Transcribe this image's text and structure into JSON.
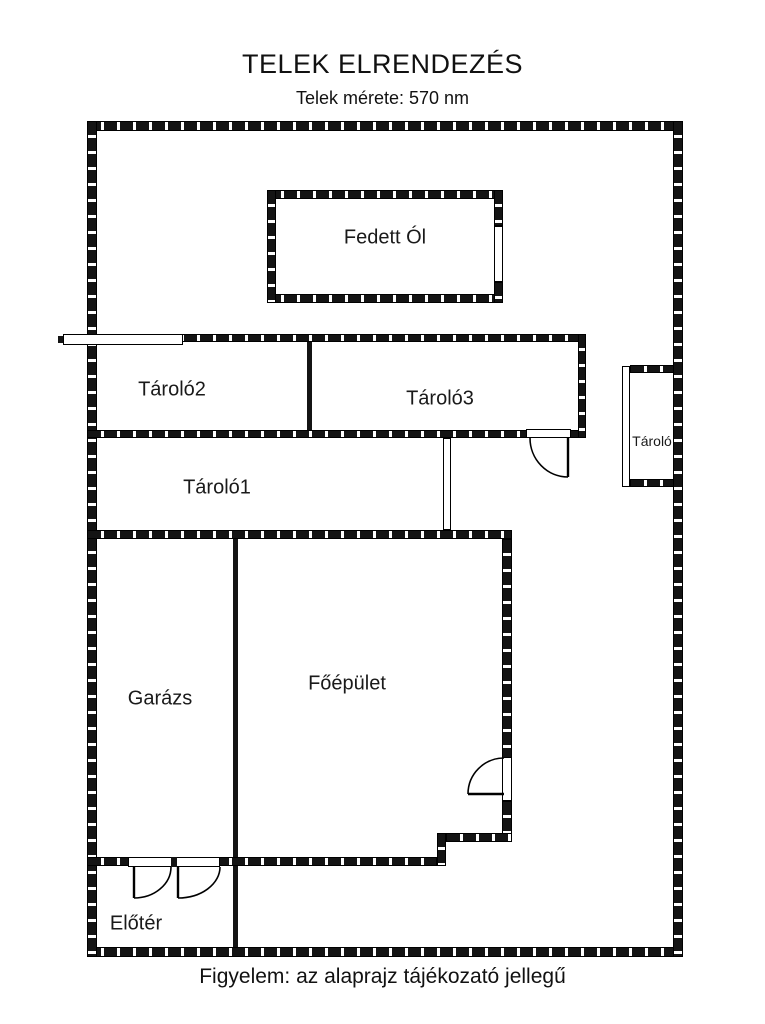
{
  "header": {
    "title": "TELEK ELRENDEZÉS",
    "subtitle": "Telek mérete: 570 nm"
  },
  "footer": {
    "note": "Figyelem: az alaprajz tájékozató jellegű"
  },
  "rooms": {
    "fedett_ol": {
      "label": "Fedett Ól"
    },
    "tarolo2": {
      "label": "Tároló2"
    },
    "tarolo3": {
      "label": "Tároló3"
    },
    "tarolo1": {
      "label": "Tároló1"
    },
    "tarolo_kicsi": {
      "label": "Tároló"
    },
    "garazs": {
      "label": "Garázs"
    },
    "foepulet": {
      "label": "Főépület"
    },
    "eloter": {
      "label": "Előtér"
    }
  },
  "colors": {
    "wall": "#141414",
    "background": "#ffffff",
    "text": "#1a1a1a"
  }
}
